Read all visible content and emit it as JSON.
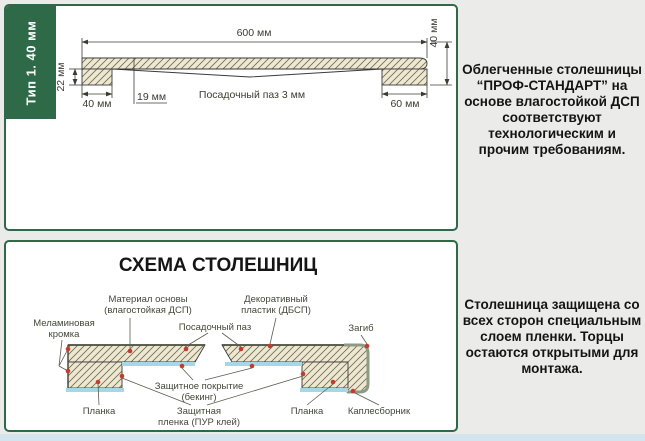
{
  "descriptions": {
    "top": "Облегченные столешницы “ПРОФ-СТАНДАРТ” на основе влагостойкой ДСП соответствуют технологическим и прочим требованиям.",
    "bottom": "Столешница защищена со всех сторон специальным слоем пленки. Торцы остаются открытыми для монтажа."
  },
  "panel_type1": {
    "sidebar_label": "Тип 1. 40 мм",
    "dim_total_width": "600 мм",
    "dim_total_height": "40 мм",
    "dim_left_height": "22 мм",
    "dim_left_block": "40 мм",
    "dim_groove_offset": "19 мм",
    "groove_label": "Посадочный паз 3 мм",
    "dim_right_block": "60 мм"
  },
  "panel_schema": {
    "title": "СХЕМА СТОЛЕШНИЦ",
    "labels": {
      "melamine": [
        "Меламиновая",
        "кромка"
      ],
      "base": [
        "Материал основы",
        "(влагостойкая ДСП)"
      ],
      "groove": "Посадочный паз",
      "plastic": [
        "Декоративный",
        "пластик (ДБСП)"
      ],
      "bend": "Загиб",
      "coating": [
        "Защитное покрытие",
        "(бекинг)"
      ],
      "plank_left": "Планка",
      "film": [
        "Защитная",
        "пленка (ПУР клей)"
      ],
      "plank_right": "Планка",
      "drip": "Каплесборник"
    }
  },
  "colors": {
    "panel_border_green": "#2e6a47",
    "badge_green": "#2e6a47",
    "hatch_fill": "#efe8d1",
    "film_blue": "#a6d7e8",
    "wrap_gray_green": "#8c9b86",
    "marker_red": "#c23b2e",
    "text_dark": "#141414"
  }
}
